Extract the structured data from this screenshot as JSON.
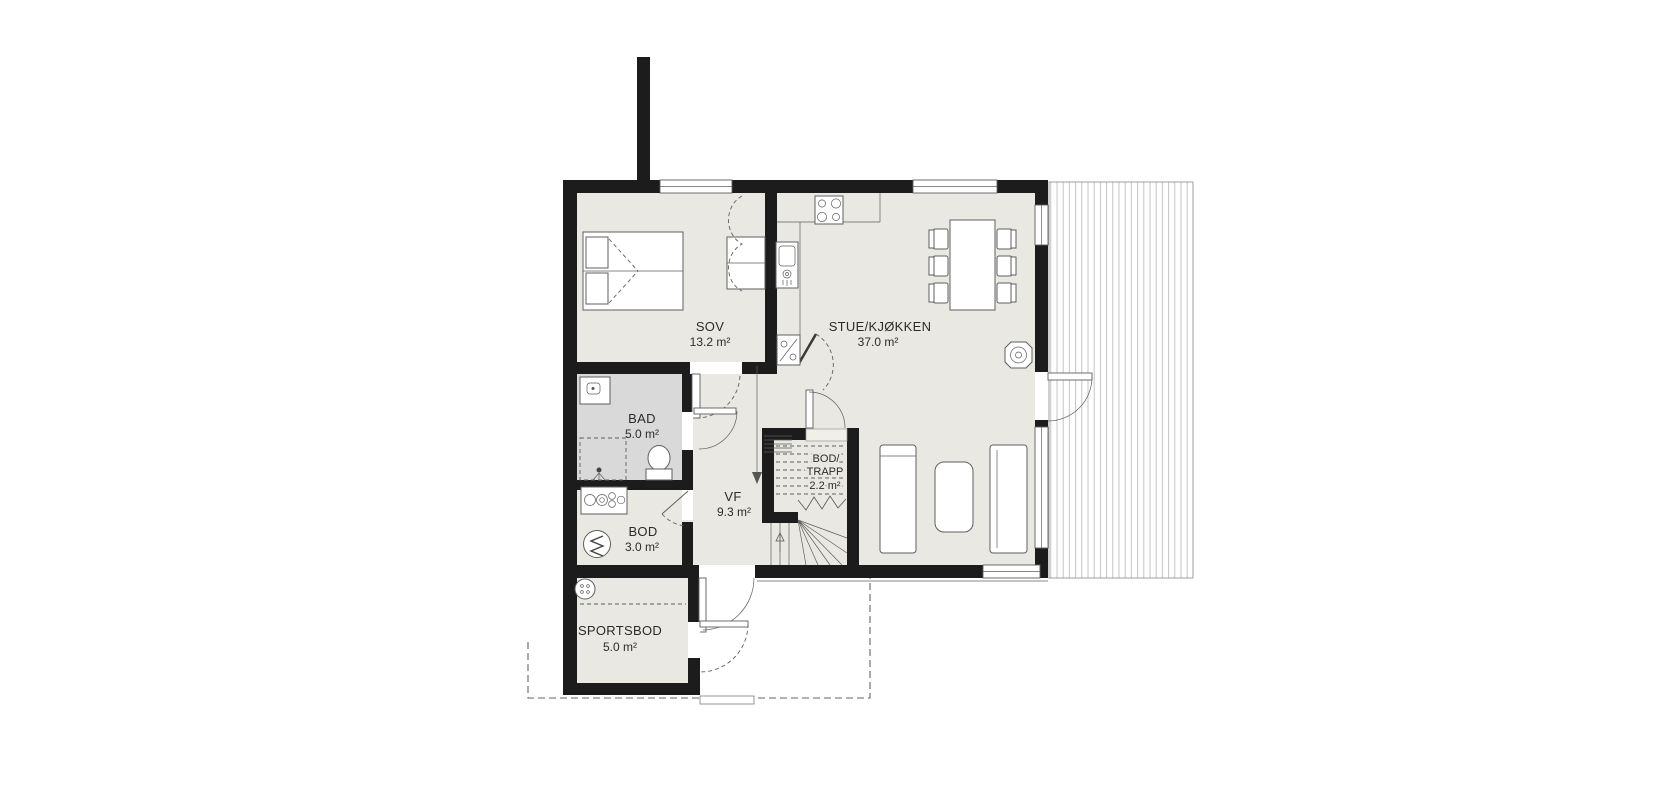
{
  "plan": {
    "title": "floor-plan",
    "colors": {
      "wall": "#1c1c1c",
      "floor": "#e9e8e2",
      "bathroom-floor": "#d9d9d9",
      "line": "#5f5f5f",
      "text": "#2b2b2b",
      "dash": "#666666",
      "deck-line": "#bdbdbd"
    },
    "rooms": [
      {
        "id": "sov",
        "name": "SOV",
        "area": "13.2 m²"
      },
      {
        "id": "stue-kjokken",
        "name": "STUE/KJØKKEN",
        "area": "37.0 m²"
      },
      {
        "id": "bad",
        "name": "BAD",
        "area": "5.0 m²"
      },
      {
        "id": "vf",
        "name": "VF",
        "area": "9.3 m²"
      },
      {
        "id": "bod-trapp",
        "name_line1": "BOD/",
        "name_line2": "TRAPP",
        "area": "2.2 m²"
      },
      {
        "id": "bod",
        "name": "BOD",
        "area": "3.0 m²"
      },
      {
        "id": "sportsbod",
        "name": "SPORTSBOD",
        "area": "5.0 m²"
      }
    ]
  }
}
